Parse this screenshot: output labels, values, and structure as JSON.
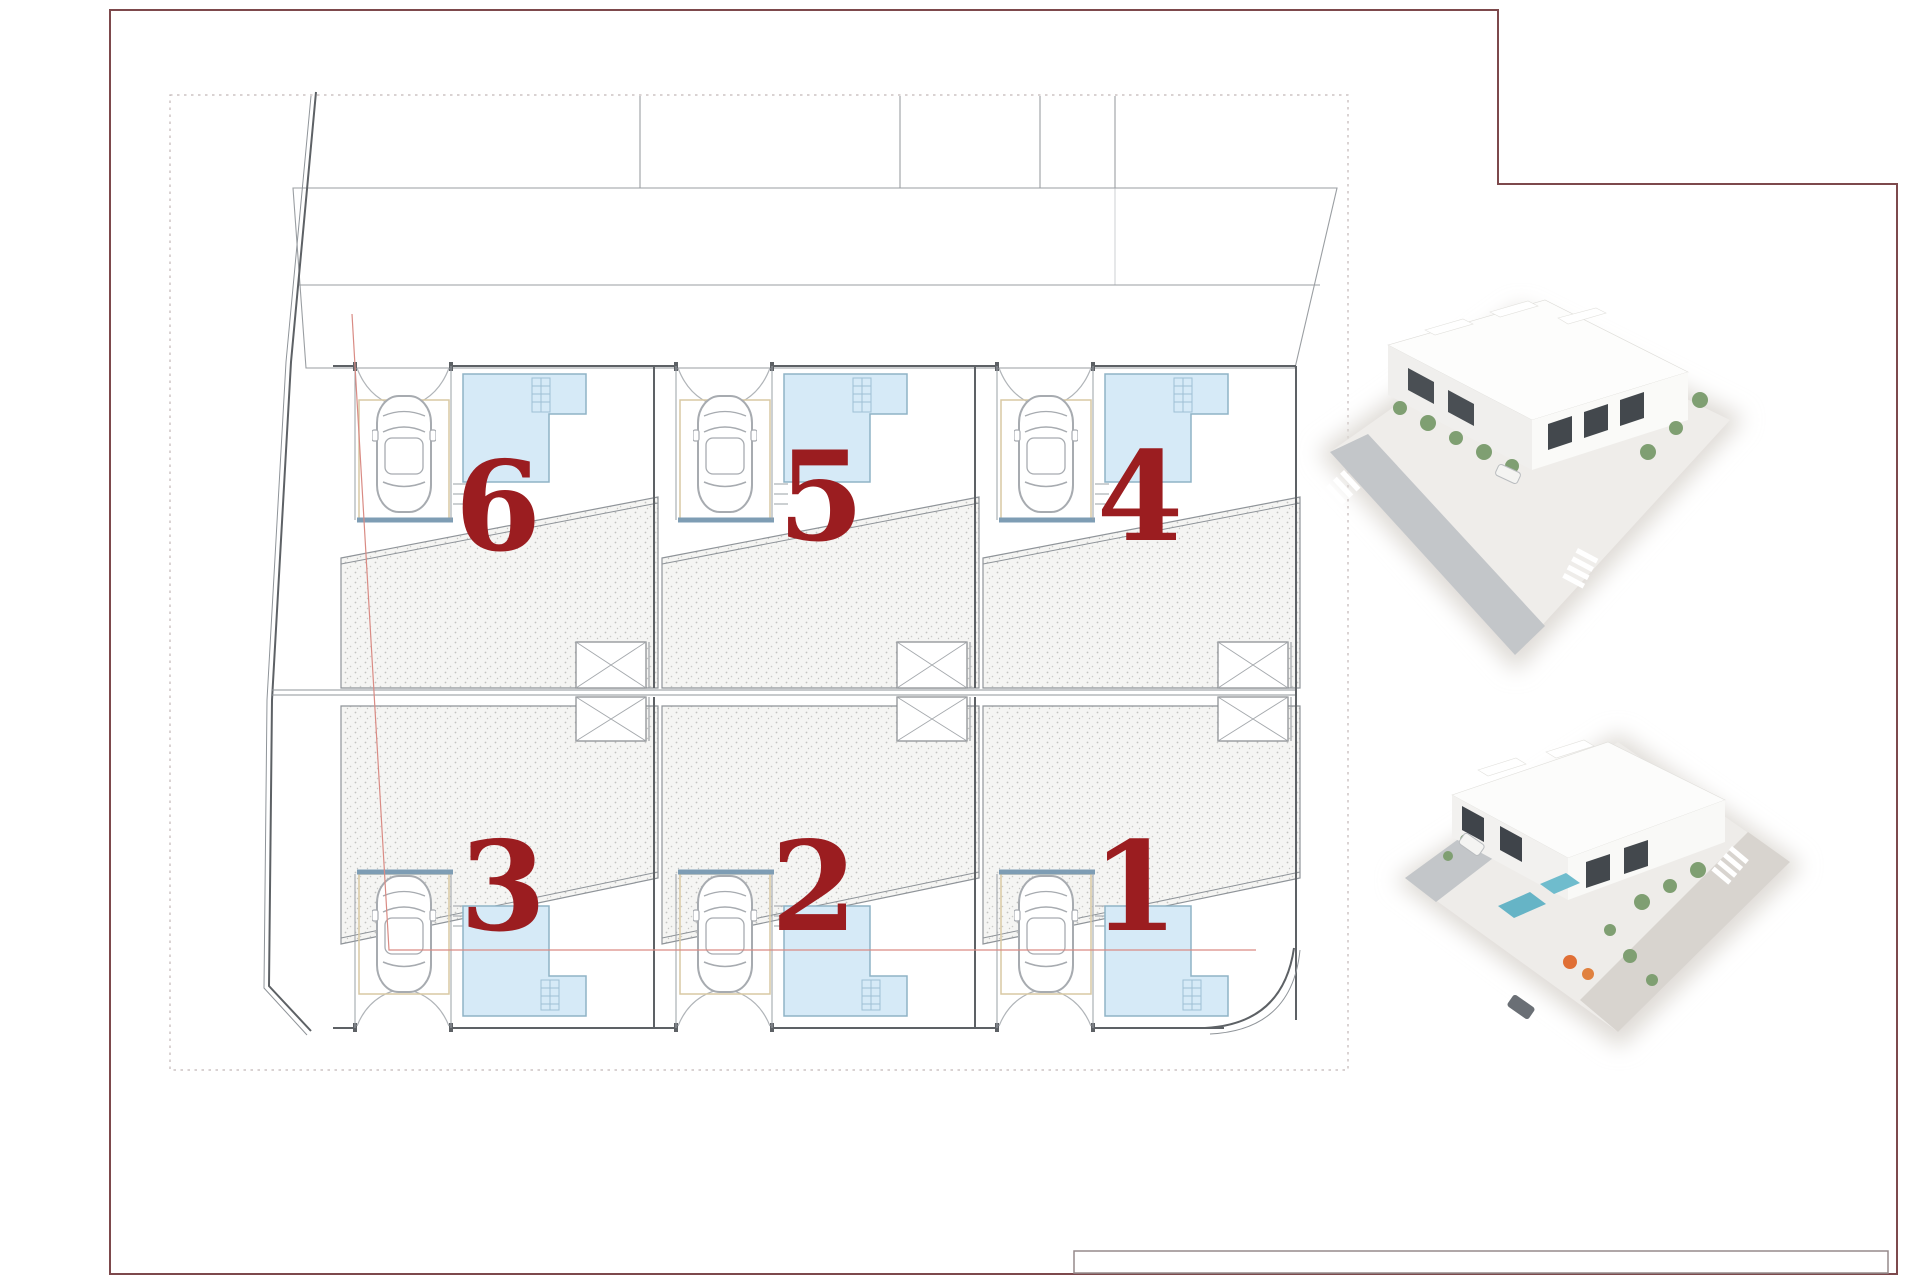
{
  "plan": {
    "units": [
      {
        "label": "6",
        "row": "top",
        "col": 0
      },
      {
        "label": "5",
        "row": "top",
        "col": 1
      },
      {
        "label": "4",
        "row": "top",
        "col": 2
      },
      {
        "label": "3",
        "row": "bottom",
        "col": 0
      },
      {
        "label": "2",
        "row": "bottom",
        "col": 1
      },
      {
        "label": "1",
        "row": "bottom",
        "col": 2
      }
    ],
    "symbols": {
      "car": "car-top-view-icon",
      "pool": "pool-with-steps-icon",
      "stairs": "stair-cross-icon",
      "entry": "arch-canopy-icon",
      "terrace": "stippled-terrace-area",
      "roof": "diagonal-hatch-roof"
    },
    "colors": {
      "unit_number": "#9b1d20",
      "pool_fill": "#d6eaf7",
      "pool_stroke": "#8fb3c6",
      "sheet_border": "#7d494c",
      "old_boundary_red_line": "#d98b84",
      "carport_pad": "#d9c9a3",
      "garden_wall": "#7e9db4"
    }
  },
  "renders": {
    "count": 2,
    "items": [
      {
        "name": "aerial-render-street-view"
      },
      {
        "name": "aerial-render-pool-terrace-view"
      }
    ]
  }
}
